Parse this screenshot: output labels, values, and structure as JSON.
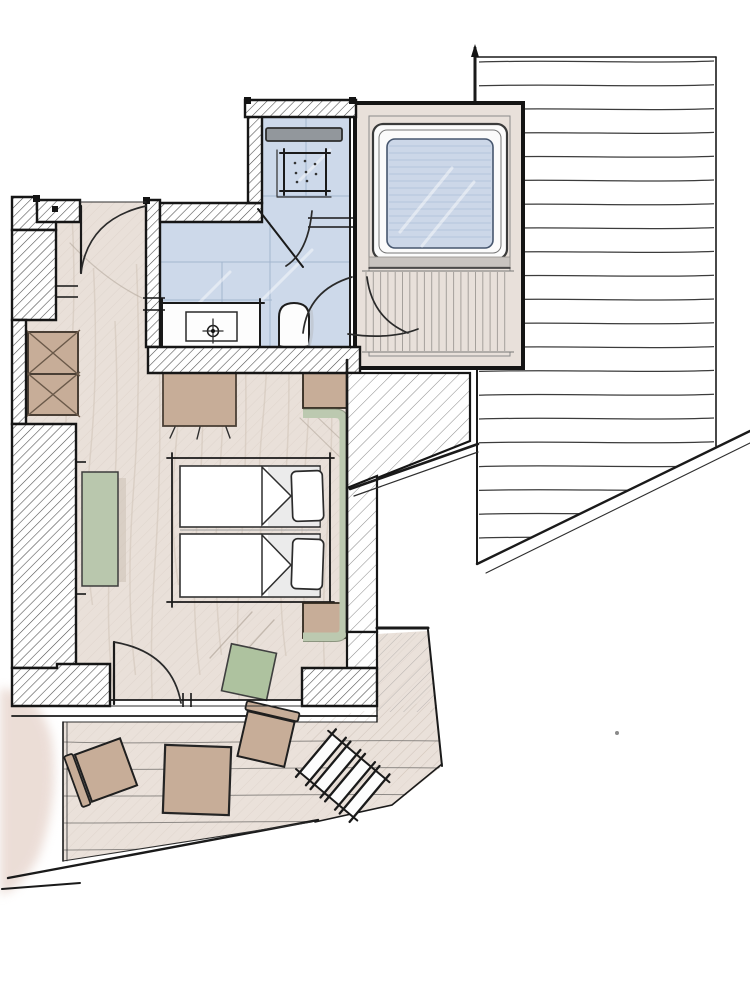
{
  "meta": {
    "description": "Hand-drawn architectural floor plan sketch of an attic room: tiled bathroom with shower, washbasin and toilet, dormer bay with skylight window, bedroom with double bed and wardrobes, adjacent roof surface and a wooden roof terrace with table, chairs and stairs",
    "canvas": {
      "width": 750,
      "height": 1000
    }
  },
  "colors": {
    "paper": "#ffffff",
    "wall_ink": "#161616",
    "bathroom_tile": "#cdd9ea",
    "tile_joint": "#9db1cb",
    "floor_wood": "#e9e0d9",
    "floor_grain": "#d0c2b6",
    "terrace_deck": "#eae1da",
    "plank_line": "#6f6c69",
    "dormer_shell": "#e8e0da",
    "window_glass": "#ccd7e8",
    "glass_streak": "#b3c2da",
    "window_frame": "#fbfbfb",
    "panel_stripe": "#a5a09b",
    "sill_gray": "#c9c4c0",
    "mirror_gray": "#92979c",
    "furniture_wood": "#c7ad98",
    "furniture_outline": "#1f1f1f",
    "accent_green": "#b9c7ad",
    "cushion_green": "#aec29f",
    "headboard_sage": "#bcc9b0",
    "fixture_white": "#fdfdfd",
    "shadow_gray": "#bfc6cf",
    "ground_wash": "#e7d5cd",
    "roof_line": "#3c3c3c"
  },
  "rooms": [
    {
      "id": "bathroom",
      "name": "bathroom",
      "features": [
        "shower-tray",
        "shower-door",
        "washbasin-counter",
        "faucet",
        "toilet",
        "mirror-strip",
        "tiled-floor"
      ]
    },
    {
      "id": "dormer-bay",
      "name": "dormer window bay",
      "features": [
        "skylight-window",
        "window-sill",
        "striped-plank-floor",
        "swing-door"
      ]
    },
    {
      "id": "bedroom",
      "name": "bedroom",
      "features": [
        "double-bed",
        "two-duvets",
        "two-pillows",
        "nightstand-top",
        "nightstand-bottom",
        "headboard",
        "foot-bench",
        "wardrobe-two-boxes",
        "wall-bench-green",
        "cushion-chair",
        "entry-door",
        "terrace-door"
      ]
    },
    {
      "id": "terrace",
      "name": "roof terrace",
      "features": [
        "wood-decking",
        "table",
        "chair-left",
        "chair-right",
        "stairs-down"
      ]
    },
    {
      "id": "roof",
      "name": "adjacent roof surface",
      "features": [
        "horizontal-plank-lines",
        "sloped-eave-edge"
      ]
    }
  ]
}
